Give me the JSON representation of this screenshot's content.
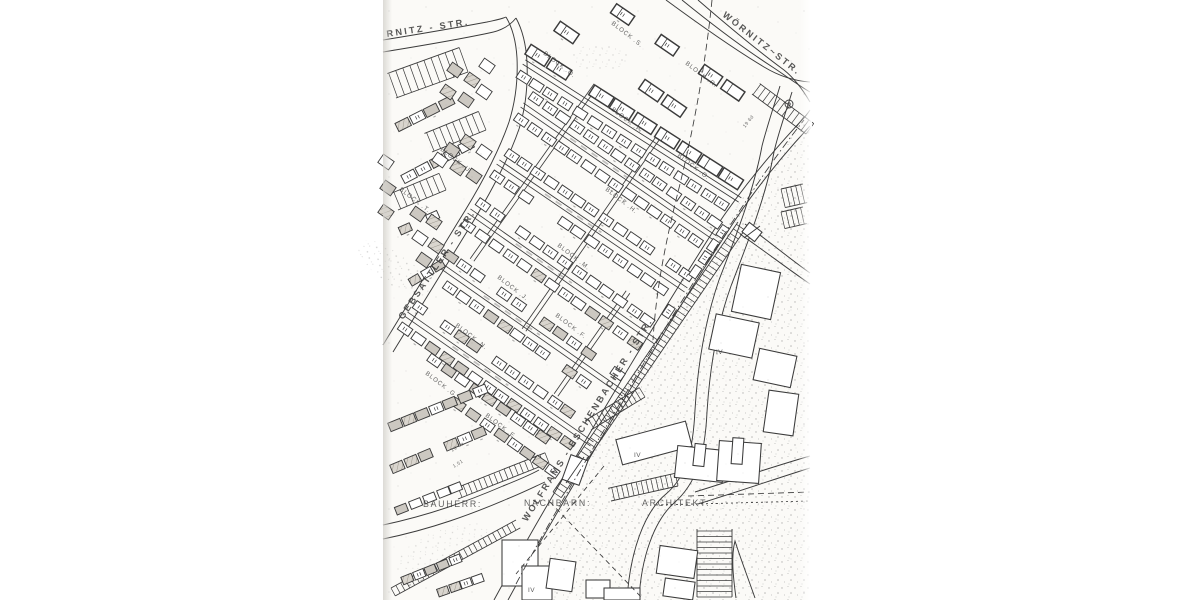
{
  "colors": {
    "paper": "#fbfaf7",
    "ink": "#3a3a3a"
  },
  "streets": {
    "woernitz_left": {
      "label": "RNITZ - STR."
    },
    "woernitz_right": {
      "label": "WÖRNITZ~STR."
    },
    "gebsattler": {
      "label": "GEBSATTLER - STR."
    },
    "wolframs_eschenbacher": {
      "label": "WOLFRAMS - ESCHENBACHER - STR."
    }
  },
  "blocks": [
    {
      "label": "BLOCK .S."
    },
    {
      "label": "BLOCK .R."
    },
    {
      "label": "BLOCK .Q."
    },
    {
      "label": "BLOCK .P."
    },
    {
      "label": "BLOCK .O."
    },
    {
      "label": "BLOCK .H."
    },
    {
      "label": "BLOCK .M."
    },
    {
      "label": "BLOCK .J."
    },
    {
      "label": "BLOCK .N."
    },
    {
      "label": "BLOCK .G."
    },
    {
      "label": "BLOCK .F."
    },
    {
      "label": "BLOCK .E."
    },
    {
      "label": "BLOCK .T."
    },
    {
      "label": "BLOCK .U."
    }
  ],
  "parties": {
    "bauherr": "BAUHERR:",
    "nachbarn": "NACHBARN:",
    "architekt": "ARCHITEKT: ·"
  },
  "storey_marks": [
    {
      "label": "IV"
    },
    {
      "label": "IV"
    },
    {
      "label": "IV"
    }
  ],
  "dimensions": [
    {
      "label": "19 6a"
    },
    {
      "label": "1,51"
    },
    {
      "label": "19 6d"
    }
  ]
}
